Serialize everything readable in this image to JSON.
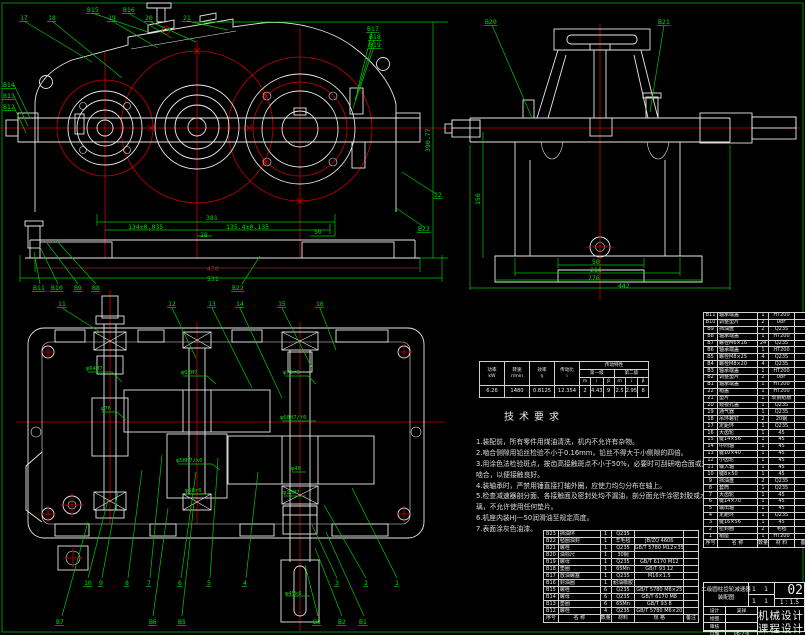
{
  "colors": {
    "background": "#000000",
    "geometry": "#e8e8e8",
    "centerline": "#c80000",
    "annotation": "#00c800",
    "dim_secondary": "#8b2a2a"
  },
  "annotations": {
    "front_view": {
      "part_labels": [
        {
          "t": "17",
          "x": 20,
          "y": 20
        },
        {
          "t": "18",
          "x": 48,
          "y": 20
        },
        {
          "t": "B15",
          "x": 87,
          "y": 12
        },
        {
          "t": "19",
          "x": 108,
          "y": 20
        },
        {
          "t": "B16",
          "x": 123,
          "y": 12
        },
        {
          "t": "20",
          "x": 145,
          "y": 20
        },
        {
          "t": "21",
          "x": 183,
          "y": 20
        },
        {
          "t": "B17",
          "x": 367,
          "y": 31
        },
        {
          "t": "B18",
          "x": 369,
          "y": 39
        },
        {
          "t": "B19",
          "x": 369,
          "y": 47
        },
        {
          "t": "B14",
          "x": 3,
          "y": 87
        },
        {
          "t": "B13",
          "x": 3,
          "y": 98
        },
        {
          "t": "B12",
          "x": 3,
          "y": 109
        },
        {
          "t": "B11",
          "x": 33,
          "y": 290
        },
        {
          "t": "B10",
          "x": 51,
          "y": 290
        },
        {
          "t": "B9",
          "x": 74,
          "y": 290
        },
        {
          "t": "B8",
          "x": 92,
          "y": 290
        },
        {
          "t": "B22",
          "x": 232,
          "y": 290
        },
        {
          "t": "22",
          "x": 434,
          "y": 197
        },
        {
          "t": "B23",
          "x": 418,
          "y": 231
        }
      ],
      "dimensions": [
        {
          "t": "381",
          "x": 206,
          "y": 220
        },
        {
          "t": "134±0.035",
          "x": 128,
          "y": 229
        },
        {
          "t": "135.4±0.135",
          "x": 226,
          "y": 229
        },
        {
          "t": "28",
          "x": 200,
          "y": 237
        },
        {
          "t": "50",
          "x": 314,
          "y": 234
        },
        {
          "t": "470",
          "x": 207,
          "y": 271,
          "c": "tdr"
        },
        {
          "t": "531",
          "x": 207,
          "y": 281
        }
      ]
    },
    "side_view": {
      "part_labels": [
        {
          "t": "B20",
          "x": 485,
          "y": 24
        },
        {
          "t": "B21",
          "x": 658,
          "y": 24
        }
      ],
      "dimensions": [
        {
          "t": "390.77",
          "x": 430,
          "y": 152,
          "r": -90
        },
        {
          "t": "150",
          "x": 480,
          "y": 205,
          "r": -90
        },
        {
          "t": "50",
          "x": 592,
          "y": 264
        },
        {
          "t": "216",
          "x": 590,
          "y": 272
        },
        {
          "t": "276",
          "x": 588,
          "y": 280
        },
        {
          "t": "442",
          "x": 618,
          "y": 288
        }
      ]
    },
    "plan_view": {
      "part_labels": [
        {
          "t": "11",
          "x": 58,
          "y": 306
        },
        {
          "t": "12",
          "x": 168,
          "y": 306
        },
        {
          "t": "13",
          "x": 208,
          "y": 306
        },
        {
          "t": "14",
          "x": 236,
          "y": 306
        },
        {
          "t": "15",
          "x": 278,
          "y": 306
        },
        {
          "t": "16",
          "x": 316,
          "y": 306
        },
        {
          "t": "10",
          "x": 84,
          "y": 585
        },
        {
          "t": "9",
          "x": 99,
          "y": 585
        },
        {
          "t": "8",
          "x": 125,
          "y": 585
        },
        {
          "t": "7",
          "x": 147,
          "y": 585
        },
        {
          "t": "6",
          "x": 178,
          "y": 585
        },
        {
          "t": "5",
          "x": 207,
          "y": 585
        },
        {
          "t": "4",
          "x": 243,
          "y": 585
        },
        {
          "t": "3",
          "x": 335,
          "y": 585
        },
        {
          "t": "2",
          "x": 364,
          "y": 585
        },
        {
          "t": "1",
          "x": 395,
          "y": 585
        },
        {
          "t": "B7",
          "x": 56,
          "y": 624
        },
        {
          "t": "B6",
          "x": 149,
          "y": 624
        },
        {
          "t": "B5",
          "x": 178,
          "y": 624
        },
        {
          "t": "B3",
          "x": 313,
          "y": 624
        },
        {
          "t": "B2",
          "x": 338,
          "y": 624
        },
        {
          "t": "B1",
          "x": 359,
          "y": 624
        }
      ],
      "fit_callouts": [
        {
          "t": "φ64H7",
          "x": 86,
          "y": 370
        },
        {
          "t": "φ62H7",
          "x": 181,
          "y": 374
        },
        {
          "t": "φ72r6",
          "x": 283,
          "y": 374
        },
        {
          "t": "φ76",
          "x": 101,
          "y": 410
        },
        {
          "t": "φ60H7/f6",
          "x": 280,
          "y": 419
        },
        {
          "t": "φ58H7/k6",
          "x": 176,
          "y": 462
        },
        {
          "t": "φ58r6",
          "x": 185,
          "y": 492
        },
        {
          "t": "φ48",
          "x": 291,
          "y": 470
        },
        {
          "t": "φ16H7",
          "x": 283,
          "y": 494
        },
        {
          "t": "φ45k6",
          "x": 285,
          "y": 595
        }
      ]
    }
  },
  "spec_table": {
    "group_title": "传动特性",
    "columns": [
      {
        "h": "功率",
        "u": "kW",
        "v": "6.26"
      },
      {
        "h": "转速",
        "u": "r/min",
        "v": "1480"
      },
      {
        "h": "效率",
        "u": "η",
        "v": "0.8125"
      },
      {
        "h": "传动比",
        "u": "i",
        "v": "12.354"
      }
    ],
    "stages": [
      {
        "name": "第一级",
        "cells": [
          {
            "h": "m",
            "v": "2"
          },
          {
            "h": "i",
            "v": "4.43"
          },
          {
            "h": "β",
            "v": "9"
          }
        ]
      },
      {
        "name": "第二级",
        "cells": [
          {
            "h": "m",
            "v": "2.5"
          },
          {
            "h": "i",
            "v": "2.95"
          },
          {
            "h": "β",
            "v": "8"
          }
        ]
      }
    ]
  },
  "tech_requirements": {
    "title": "技术要求",
    "items": [
      "1.装配前，所有零件用煤油清洗，机内不允许有杂物。",
      "2.啮合侧隙用铅丝检验不小于0.16mm，铅丝不得大于小侧隙的四倍。",
      "3.用涂色法检验斑点，按齿高接触斑点不小于50%，必要时可刮研啮合面或对研啮合，以便接触良好。",
      "4.装轴承时，严禁用锤直接打轴外圈，应使力均匀分布在轴上。",
      "5.检查减速器剖分面、各接触面及密封处均不漏油，剖分面允许涂密封胶或水玻璃，不允许使用任何垫片。",
      "6.机座内装HJ—50润滑油至规定高度。",
      "7.表面涂灰色油漆。"
    ]
  },
  "std_parts_table": {
    "header": [
      "序号",
      "名 称",
      "数量",
      "材料",
      "规 格",
      "备注"
    ],
    "rows": [
      {
        "id": "B23",
        "name": "挡油环",
        "qty": "1",
        "material": "Q235",
        "standard": ""
      },
      {
        "id": "B22",
        "name": "毡圈油封",
        "qty": "1",
        "material": "羊毛毡",
        "standard": "JB/ZQ 4606"
      },
      {
        "id": "B21",
        "name": "螺栓",
        "qty": "1",
        "material": "Q235",
        "standard": "GB/T 5780 M12×35"
      },
      {
        "id": "B20",
        "name": "油标尺",
        "qty": "1",
        "material": "30钢",
        "standard": ""
      },
      {
        "id": "B19",
        "name": "螺母",
        "qty": "1",
        "material": "Q235",
        "standard": "GB/T 6170 M12"
      },
      {
        "id": "B18",
        "name": "垫圈",
        "qty": "1",
        "material": "65Mn",
        "standard": "GB/T 93 12"
      },
      {
        "id": "B17",
        "name": "放油螺塞",
        "qty": "1",
        "material": "Q235",
        "standard": "M16×1.5"
      },
      {
        "id": "B16",
        "name": "封油圈",
        "qty": "1",
        "material": "耐油橡胶",
        "standard": ""
      },
      {
        "id": "B15",
        "name": "螺栓",
        "qty": "6",
        "material": "Q235",
        "standard": "GB/T 5780 M8×25"
      },
      {
        "id": "B14",
        "name": "螺母",
        "qty": "6",
        "material": "Q235",
        "standard": "GB/T 6170 M8"
      },
      {
        "id": "B13",
        "name": "垫圈",
        "qty": "6",
        "material": "65Mn",
        "standard": "GB/T 93 8"
      },
      {
        "id": "B12",
        "name": "螺栓",
        "qty": "4",
        "material": "Q235",
        "standard": "GB/T 5780 M6×20"
      }
    ]
  },
  "main_parts_table": {
    "header": [
      "序号",
      "名 称",
      "数量",
      "材 料",
      "备注"
    ],
    "rows": [
      {
        "id": "B11",
        "name": "轴承端盖",
        "qty": "1",
        "material": "HT200"
      },
      {
        "id": "B10",
        "name": "调整垫片",
        "qty": "2",
        "material": "08F"
      },
      {
        "id": "B9",
        "name": "挡油盘",
        "qty": "2",
        "material": "Q235"
      },
      {
        "id": "B8",
        "name": "轴承端盖",
        "qty": "1",
        "material": "HT200"
      },
      {
        "id": "B7",
        "name": "螺栓M6×16",
        "qty": "24",
        "material": "Q235"
      },
      {
        "id": "B6",
        "name": "轴承端盖",
        "qty": "1",
        "material": "HT200"
      },
      {
        "id": "B5",
        "name": "螺栓M8×25",
        "qty": "4",
        "material": "Q235"
      },
      {
        "id": "B4",
        "name": "螺栓M8×20",
        "qty": "4",
        "material": "Q235"
      },
      {
        "id": "B3",
        "name": "轴承端盖",
        "qty": "1",
        "material": "HT200"
      },
      {
        "id": "B2",
        "name": "调整垫片",
        "qty": "2",
        "material": "08F"
      },
      {
        "id": "B1",
        "name": "轴承端盖",
        "qty": "1",
        "material": "HT200"
      },
      {
        "id": "22",
        "name": "箱盖",
        "qty": "1",
        "material": "HT200"
      },
      {
        "id": "21",
        "name": "垫片",
        "qty": "1",
        "material": "软钢纸板"
      },
      {
        "id": "20",
        "name": "窥视孔盖",
        "qty": "1",
        "material": "Q235"
      },
      {
        "id": "19",
        "name": "通气器",
        "qty": "1",
        "material": "Q235"
      },
      {
        "id": "18",
        "name": "吊环螺钉",
        "qty": "2",
        "material": "20钢"
      },
      {
        "id": "17",
        "name": "定距环",
        "qty": "1",
        "material": "Q235"
      },
      {
        "id": "16",
        "name": "大齿轮",
        "qty": "1",
        "material": "45"
      },
      {
        "id": "15",
        "name": "键14×56",
        "qty": "1",
        "material": "45"
      },
      {
        "id": "14",
        "name": "中间轴",
        "qty": "1",
        "material": "45"
      },
      {
        "id": "13",
        "name": "键10×40",
        "qty": "1",
        "material": "45"
      },
      {
        "id": "12",
        "name": "小齿轮",
        "qty": "1",
        "material": "45"
      },
      {
        "id": "11",
        "name": "输入轴",
        "qty": "1",
        "material": "45"
      },
      {
        "id": "10",
        "name": "键8×50",
        "qty": "1",
        "material": "45"
      },
      {
        "id": "9",
        "name": "挡油盘",
        "qty": "2",
        "material": "Q235"
      },
      {
        "id": "8",
        "name": "套筒",
        "qty": "1",
        "material": "Q235"
      },
      {
        "id": "7",
        "name": "大齿轮",
        "qty": "1",
        "material": "45"
      },
      {
        "id": "6",
        "name": "键14×70",
        "qty": "1",
        "material": "45"
      },
      {
        "id": "5",
        "name": "输出轴",
        "qty": "1",
        "material": "45"
      },
      {
        "id": "4",
        "name": "定距环",
        "qty": "1",
        "material": "Q235"
      },
      {
        "id": "3",
        "name": "键16×56",
        "qty": "1",
        "material": "45"
      },
      {
        "id": "2",
        "name": "密封圈",
        "qty": "2",
        "material": "毛毡"
      },
      {
        "id": "1",
        "name": "箱座",
        "qty": "1",
        "material": "HT200"
      }
    ]
  },
  "title_block": {
    "drawing_name_line1": "二级圆柱齿轮减速器",
    "drawing_name_line2": "装配图",
    "sheet": "1 1",
    "sheet2": "1 1",
    "drawing_no": "02",
    "scale": "1 : 1.5",
    "fields": [
      {
        "label": "设计",
        "value": "吴祥"
      },
      {
        "label": "绘图",
        "value": ""
      },
      {
        "label": "审核",
        "value": ""
      },
      {
        "label": "日期",
        "value": "06-7-6"
      }
    ],
    "course_line1": "机械设计",
    "course_line2": "课程设计"
  }
}
